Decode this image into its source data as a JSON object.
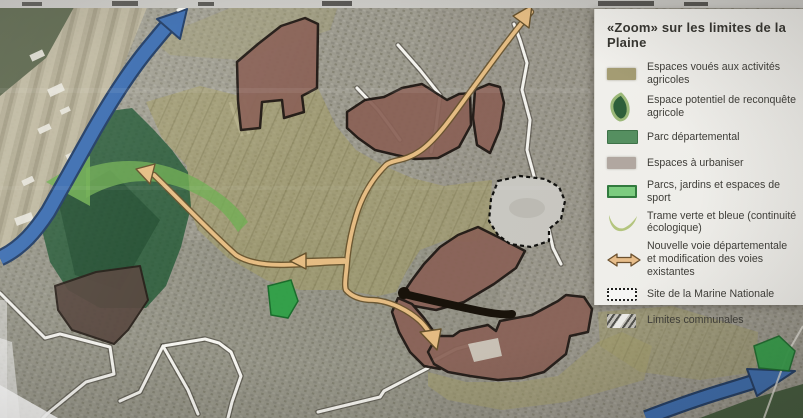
{
  "poster": {
    "kind": "photograph of an urban-planning map poster",
    "map_text": ""
  },
  "legend": {
    "title": "«Zoom» sur les limites de la Plaine",
    "items": [
      {
        "id": "espaces-agricoles",
        "label": "Espaces voués aux activités agricoles",
        "swatch_color": "#a59d73"
      },
      {
        "id": "reconquete-agricole",
        "label": "Espace potentiel de reconquête agricole",
        "swatch_color": "#2c5e38"
      },
      {
        "id": "parc-departemental",
        "label": "Parc départemental",
        "swatch_color": "#54905f"
      },
      {
        "id": "espaces-a-urbaniser",
        "label": "Espaces à urbaniser",
        "swatch_color": "#b3a9a2"
      },
      {
        "id": "parcs-jardins-sport",
        "label": "Parcs, jardins et espaces de sport",
        "swatch_color": "#7ccf80"
      },
      {
        "id": "trame-verte-bleue",
        "label": "Trame verte et bleue (continuité écologique)",
        "swatch_color": "#b6c87f"
      },
      {
        "id": "nouvelle-voie",
        "label": "Nouvelle voie départementale et modification des voies existantes",
        "swatch_color": "#ecc08b"
      },
      {
        "id": "site-marine",
        "label": "Site de la Marine Nationale",
        "swatch_color": "#fcfcfa"
      },
      {
        "id": "limites-communales",
        "label": "Limites communales",
        "swatch_color": "#50504b"
      }
    ]
  },
  "map": {
    "features": [
      {
        "name": "riviere-trame-bleue-arrow",
        "color": "#3a6cb0"
      },
      {
        "name": "parc-departemental-area",
        "color": "#1d5531"
      },
      {
        "name": "espaces-agricoles-overlay",
        "color": "#a59f68"
      },
      {
        "name": "espaces-a-urbaniser-areas",
        "color": "#8a6156"
      },
      {
        "name": "site-marine-nationale-area",
        "color": "#cac9c3"
      },
      {
        "name": "parcs-jardins-patches",
        "color": "#2fa147"
      },
      {
        "name": "trame-verte-arrow",
        "color": "#6fae52"
      },
      {
        "name": "nouvelle-voie-arrows",
        "color": "#e6bd83"
      },
      {
        "name": "limites-communales-lines",
        "color": "#f5f4ef"
      }
    ]
  }
}
